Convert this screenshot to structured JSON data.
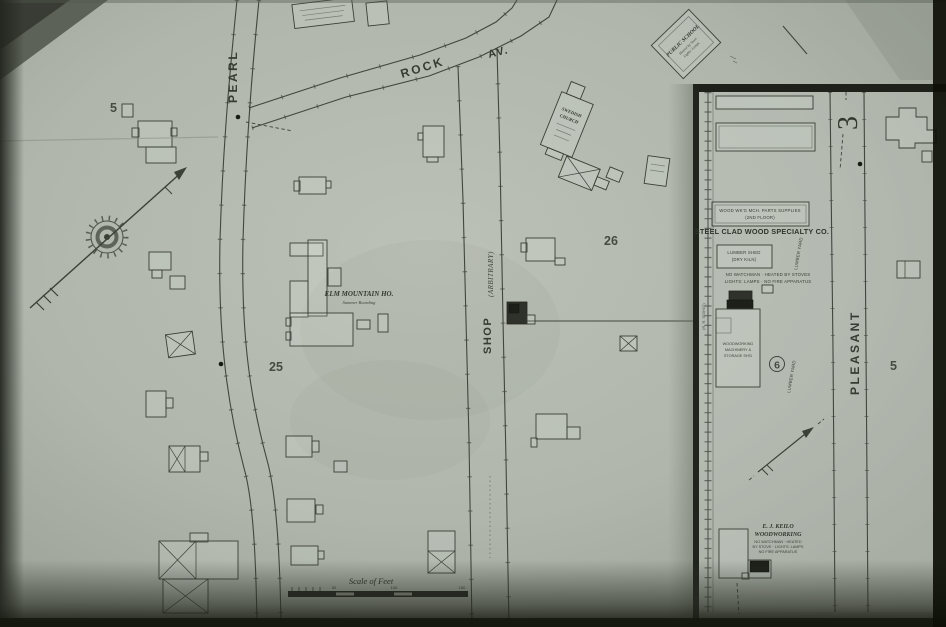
{
  "colors": {
    "paper": "#b3b9af",
    "ink": "#3a3f36",
    "black_fill": "#1d2019"
  },
  "streets": {
    "pearl": "PEARL",
    "rock": "ROCK",
    "rock_suffix": "AV.",
    "shop": "SHOP",
    "shop_qualifier": "(ARBITRARY)",
    "pleasant": "PLEASANT"
  },
  "blocks": {
    "block5_west": "5",
    "block25": "25",
    "block26": "26",
    "block6": "6",
    "block5_east": "5",
    "block3": "3"
  },
  "labels": {
    "public_school": "PUBLIC SCHOOL",
    "public_school_note1": "Heated by Stove",
    "public_school_note2": "Lights: Lamps",
    "church_line1": "SWEDISH",
    "church_line2": "CHURCH",
    "elm_house_name": "ELM MOUNTAIN HO.",
    "elm_house_note": "Summer Boarding",
    "steel_clad_title": "STEEL CLAD WOOD SPECIALTY CO.",
    "supplies_line1": "WOOD WK'G MCH. PARTS SUPPLIES",
    "supplies_line2": "(2ND FLOOR)",
    "lumber_shed_line1": "LUMBER SHED",
    "lumber_shed_line2": "(DRY KILN)",
    "factory_note1": "NO WATCHMAN · HEATED BY STOVES",
    "factory_note2": "LIGHTS: LAMPS · NO FIRE APPARATUS",
    "machinery_line1": "WOODWORKING",
    "machinery_line2": "MACHINERY &",
    "machinery_line3": "STORAGE SH'D",
    "lumber_yard": "LUMBER YARD",
    "rr_siding": "(R. R. SIDING)",
    "keilo_line1": "E. J. KEILO",
    "keilo_line2": "WOODWORKING",
    "keilo_note1": "NO WATCHMAN · HEATED",
    "keilo_note2": "BY STOVE · LIGHTS: LAMPS",
    "keilo_note3": "NO FIRE APPARATUS",
    "footnote": "· ·  · · · · · · · · ·"
  },
  "scale": {
    "title": "Scale of Feet",
    "tick_50": "50",
    "tick_100": "100",
    "tick_150": "150"
  }
}
